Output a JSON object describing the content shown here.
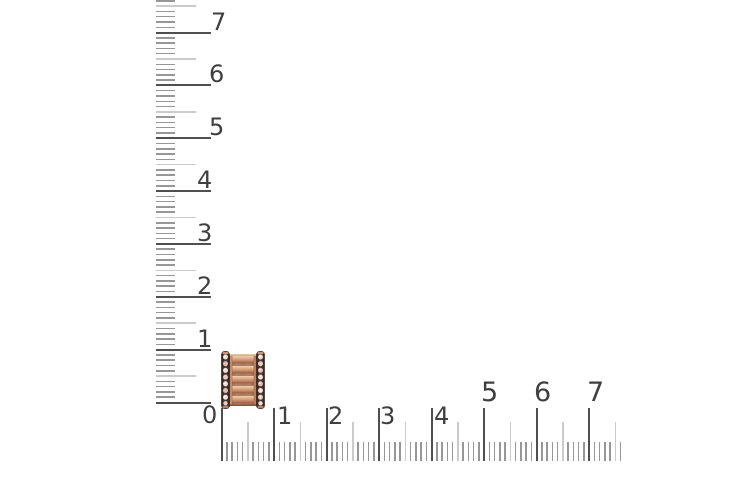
{
  "scene": {
    "type": "product-measurement-photo",
    "background_color": "#ffffff",
    "subject": "rose-gold bead charm with two dark pave gemstone rims photographed against centimeter rulers"
  },
  "rulers": {
    "label_color": "#3f3f3f",
    "tick_color_major": "#4f4f4f",
    "tick_color_minor": "#979797",
    "tick_color_half": "#cbcbcb",
    "vertical": {
      "x_start": 155.5,
      "origin_y": 402.5,
      "px_per_unit": 52.85,
      "max_units": 7.6,
      "len_major": 55,
      "len_half": 40,
      "len_minor": 19,
      "labels": [
        {
          "text": "1",
          "x": 197,
          "y": 332,
          "font": 24
        },
        {
          "text": "2",
          "x": 197,
          "y": 279,
          "font": 24
        },
        {
          "text": "3",
          "x": 197,
          "y": 226,
          "font": 24
        },
        {
          "text": "4",
          "x": 197,
          "y": 173,
          "font": 24
        },
        {
          "text": "5",
          "x": 209,
          "y": 120,
          "font": 24
        },
        {
          "text": "6",
          "x": 209,
          "y": 67,
          "font": 24
        },
        {
          "text": "7",
          "x": 211,
          "y": 15,
          "font": 24
        }
      ]
    },
    "horizontal": {
      "y_bottom": 461,
      "origin_x": 221.5,
      "px_per_unit": 52.5,
      "max_units": 7.6,
      "len_major": 53,
      "len_half": 39,
      "len_minor": 19,
      "labels": [
        {
          "text": "0",
          "x": 202,
          "y": 408,
          "font": 24
        },
        {
          "text": "1",
          "x": 277,
          "y": 409,
          "font": 24
        },
        {
          "text": "2",
          "x": 328,
          "y": 409,
          "font": 24
        },
        {
          "text": "3",
          "x": 380,
          "y": 409,
          "font": 24
        },
        {
          "text": "4",
          "x": 434,
          "y": 409,
          "font": 24
        },
        {
          "text": "5",
          "x": 481,
          "y": 385,
          "font": 27
        },
        {
          "text": "6",
          "x": 534,
          "y": 385,
          "font": 27
        },
        {
          "text": "7",
          "x": 587,
          "y": 385,
          "font": 27
        }
      ]
    }
  },
  "product": {
    "name": "bead-charm",
    "position": {
      "x": 221,
      "y": 351,
      "width": 44,
      "height": 58
    },
    "colors": {
      "gold_light": "#f3d6b4",
      "gold_mid": "#d49e7d",
      "gold_dark": "#9c6048",
      "groove": "#7c4e3a",
      "rim_dark": "#2f211c",
      "stone_light": "#eedfdb",
      "stone_pink": "#e0bdb8"
    }
  }
}
